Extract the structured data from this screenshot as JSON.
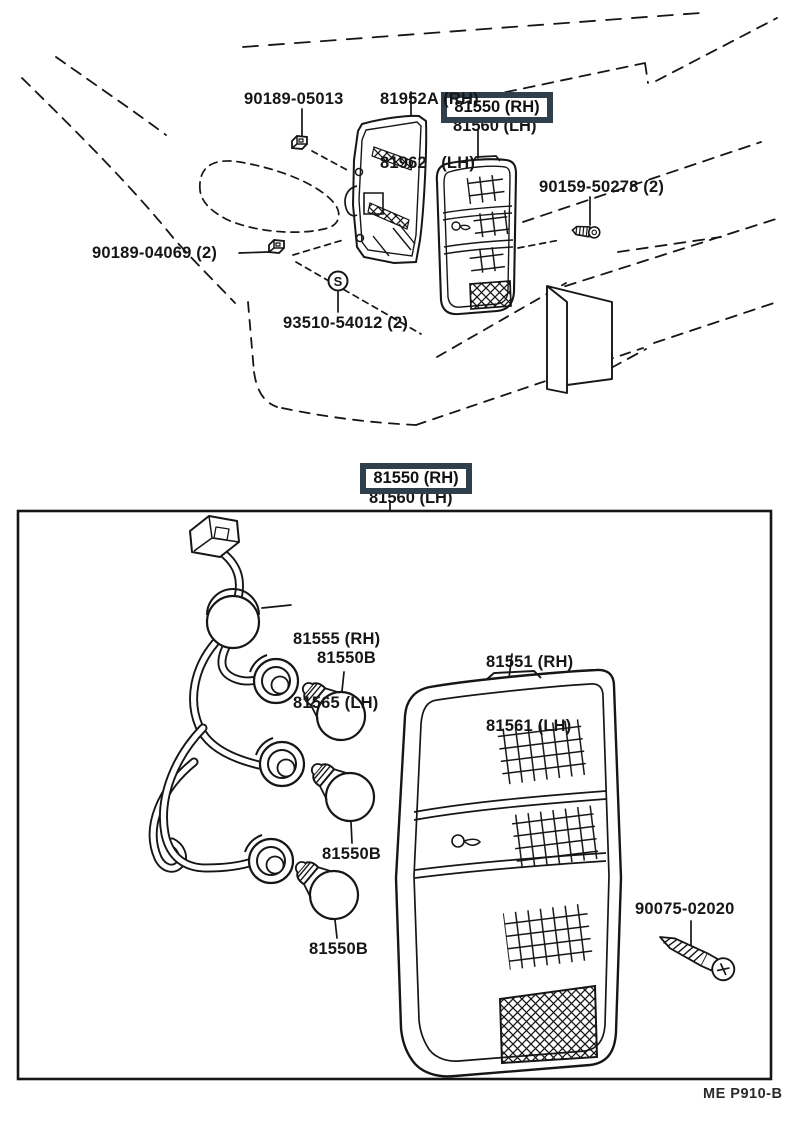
{
  "colors": {
    "highlight_box": "#2f404c",
    "ink": "#161616",
    "paper": "#ffffff"
  },
  "symbols": {
    "screw_marker": "S"
  },
  "top_view": {
    "labels": {
      "body_lamp_line1": "81952A (RH)",
      "body_lamp_line2": "81962   (LH)",
      "clip_upper": "90189-05013",
      "lens_boxed_line1": "81550 (RH)",
      "lens_boxed_line2": "81560 (LH)",
      "screw_side": "90159-50278 (2)",
      "clip_lower": "90189-04069 (2)",
      "screw_marker_part": "93510-54012 (2)"
    }
  },
  "detail_view": {
    "labels": {
      "assembly_boxed_line1": "81550 (RH)",
      "assembly_boxed_line2": "81560 (LH)",
      "cord_line1": "81555 (RH)",
      "cord_line2": "81565 (LH)",
      "bulb_1": "81550B",
      "bulb_2": "81550B",
      "bulb_3": "81550B",
      "lens_line1": "81551 (RH)",
      "lens_line2": "81561 (LH)",
      "screw": "90075-02020"
    }
  },
  "footer": {
    "drawing_code": "ME P910-B"
  }
}
